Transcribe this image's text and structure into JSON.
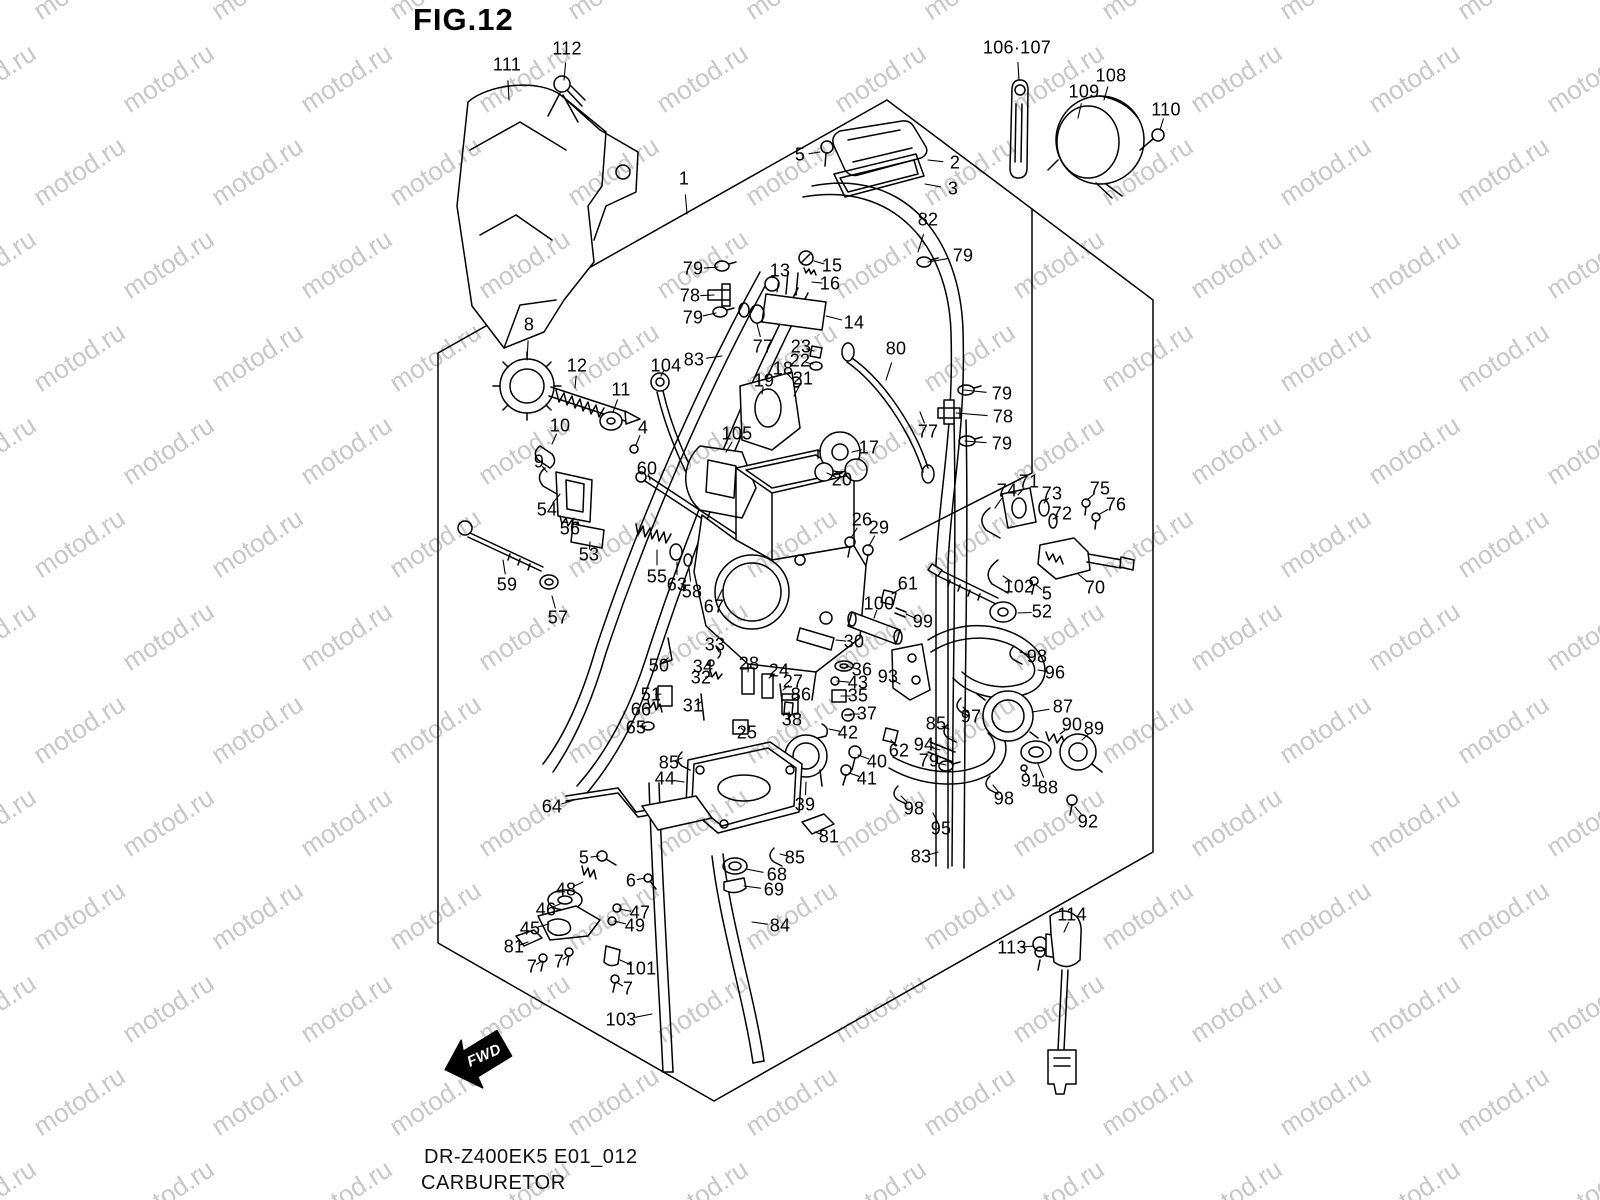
{
  "figure": {
    "label": "FIG.12"
  },
  "footer": {
    "model_code": "DR-Z400EK5 E01_012",
    "title": "CARBURETOR"
  },
  "fwd_label": "FWD",
  "watermark": {
    "text": "motod.ru"
  },
  "colors": {
    "line": "#000000",
    "watermark": "#c3c3c3",
    "background": "#ffffff"
  },
  "part_labels": [
    {
      "t": "112",
      "x": 567,
      "y": 49,
      "tx": 564,
      "ty": 80
    },
    {
      "t": "111",
      "x": 507,
      "y": 65,
      "tx": 509,
      "ty": 100
    },
    {
      "t": "106·107",
      "x": 1017,
      "y": 48,
      "tx": 1019,
      "ty": 80
    },
    {
      "t": "108",
      "x": 1111,
      "y": 76,
      "tx": 1104,
      "ty": 100
    },
    {
      "t": "109",
      "x": 1084,
      "y": 92,
      "tx": 1078,
      "ty": 118
    },
    {
      "t": "110",
      "x": 1166,
      "y": 110,
      "tx": 1160,
      "ty": 130
    },
    {
      "t": "5",
      "x": 800,
      "y": 155,
      "tx": 820,
      "ty": 152
    },
    {
      "t": "2",
      "x": 955,
      "y": 163,
      "tx": 928,
      "ty": 160
    },
    {
      "t": "3",
      "x": 953,
      "y": 189,
      "tx": 925,
      "ty": 184
    },
    {
      "t": "1",
      "x": 684,
      "y": 179,
      "tx": 687,
      "ty": 214
    },
    {
      "t": "82",
      "x": 928,
      "y": 220,
      "tx": 918,
      "ty": 252
    },
    {
      "t": "79",
      "x": 963,
      "y": 256,
      "tx": 928,
      "ty": 262
    },
    {
      "t": "79",
      "x": 693,
      "y": 269,
      "tx": 718,
      "ty": 267
    },
    {
      "t": "13",
      "x": 780,
      "y": 271,
      "tx": 777,
      "ty": 292
    },
    {
      "t": "15",
      "x": 832,
      "y": 266,
      "tx": 814,
      "ty": 261
    },
    {
      "t": "16",
      "x": 830,
      "y": 284,
      "tx": 812,
      "ty": 282
    },
    {
      "t": "78",
      "x": 690,
      "y": 296,
      "tx": 714,
      "ty": 295
    },
    {
      "t": "79",
      "x": 693,
      "y": 318,
      "tx": 716,
      "ty": 313
    },
    {
      "t": "14",
      "x": 854,
      "y": 323,
      "tx": 826,
      "ty": 316
    },
    {
      "t": "77",
      "x": 763,
      "y": 347,
      "tx": 757,
      "ty": 324
    },
    {
      "t": "23",
      "x": 801,
      "y": 347,
      "tx": 814,
      "ty": 351
    },
    {
      "t": "80",
      "x": 896,
      "y": 349,
      "tx": 886,
      "ty": 380
    },
    {
      "t": "22",
      "x": 800,
      "y": 361,
      "tx": 813,
      "ty": 364
    },
    {
      "t": "8",
      "x": 529,
      "y": 325,
      "tx": 527,
      "ty": 360
    },
    {
      "t": "12",
      "x": 577,
      "y": 366,
      "tx": 575,
      "ty": 388
    },
    {
      "t": "104",
      "x": 666,
      "y": 366,
      "tx": 661,
      "ty": 376
    },
    {
      "t": "83",
      "x": 694,
      "y": 360,
      "tx": 722,
      "ty": 356
    },
    {
      "t": "18",
      "x": 783,
      "y": 369,
      "tx": 793,
      "ty": 380
    },
    {
      "t": "21",
      "x": 803,
      "y": 379,
      "tx": 794,
      "ty": 396
    },
    {
      "t": "19",
      "x": 764,
      "y": 381,
      "tx": 762,
      "ty": 394
    },
    {
      "t": "11",
      "x": 621,
      "y": 390,
      "tx": 613,
      "ty": 412
    },
    {
      "t": "79",
      "x": 1002,
      "y": 394,
      "tx": 964,
      "ty": 390
    },
    {
      "t": "78",
      "x": 1003,
      "y": 417,
      "tx": 956,
      "ty": 413
    },
    {
      "t": "77",
      "x": 928,
      "y": 432,
      "tx": 920,
      "ty": 412
    },
    {
      "t": "79",
      "x": 1002,
      "y": 444,
      "tx": 965,
      "ty": 441
    },
    {
      "t": "10",
      "x": 560,
      "y": 426,
      "tx": 552,
      "ty": 444
    },
    {
      "t": "4",
      "x": 643,
      "y": 428,
      "tx": 636,
      "ty": 445
    },
    {
      "t": "105",
      "x": 737,
      "y": 434,
      "tx": 726,
      "ty": 452
    },
    {
      "t": "9",
      "x": 539,
      "y": 462,
      "tx": 547,
      "ty": 472
    },
    {
      "t": "17",
      "x": 869,
      "y": 448,
      "tx": 852,
      "ty": 452
    },
    {
      "t": "60",
      "x": 647,
      "y": 469,
      "tx": 650,
      "ty": 480
    },
    {
      "t": "20",
      "x": 842,
      "y": 480,
      "tx": 827,
      "ty": 473
    },
    {
      "t": "71",
      "x": 1029,
      "y": 482,
      "tx": 1018,
      "ty": 495
    },
    {
      "t": "74",
      "x": 1007,
      "y": 491,
      "tx": 995,
      "ty": 508
    },
    {
      "t": "73",
      "x": 1052,
      "y": 494,
      "tx": 1044,
      "ty": 503
    },
    {
      "t": "75",
      "x": 1100,
      "y": 489,
      "tx": 1087,
      "ty": 500
    },
    {
      "t": "76",
      "x": 1116,
      "y": 505,
      "tx": 1098,
      "ty": 515
    },
    {
      "t": "72",
      "x": 1062,
      "y": 514,
      "tx": 1053,
      "ty": 519
    },
    {
      "t": "54",
      "x": 547,
      "y": 510,
      "tx": 560,
      "ty": 494
    },
    {
      "t": "26",
      "x": 862,
      "y": 520,
      "tx": 851,
      "ty": 538
    },
    {
      "t": "29",
      "x": 879,
      "y": 528,
      "tx": 869,
      "ty": 546
    },
    {
      "t": "56",
      "x": 570,
      "y": 529,
      "tx": 574,
      "ty": 518
    },
    {
      "t": "53",
      "x": 589,
      "y": 555,
      "tx": 590,
      "ty": 542
    },
    {
      "t": "59",
      "x": 507,
      "y": 585,
      "tx": 503,
      "ty": 560
    },
    {
      "t": "55",
      "x": 657,
      "y": 577,
      "tx": 657,
      "ty": 550
    },
    {
      "t": "63",
      "x": 677,
      "y": 585,
      "tx": 677,
      "ty": 562
    },
    {
      "t": "58",
      "x": 692,
      "y": 592,
      "tx": 689,
      "ty": 568
    },
    {
      "t": "61",
      "x": 908,
      "y": 584,
      "tx": 892,
      "ty": 594
    },
    {
      "t": "102",
      "x": 1019,
      "y": 587,
      "tx": 1003,
      "ty": 576
    },
    {
      "t": "5",
      "x": 1047,
      "y": 594,
      "tx": 1035,
      "ty": 584
    },
    {
      "t": "70",
      "x": 1095,
      "y": 588,
      "tx": 1078,
      "ty": 574
    },
    {
      "t": "100",
      "x": 879,
      "y": 604,
      "tx": 874,
      "ty": 618
    },
    {
      "t": "52",
      "x": 1042,
      "y": 612,
      "tx": 1018,
      "ty": 613
    },
    {
      "t": "57",
      "x": 558,
      "y": 618,
      "tx": 552,
      "ty": 596
    },
    {
      "t": "99",
      "x": 923,
      "y": 622,
      "tx": 906,
      "ty": 614
    },
    {
      "t": "67",
      "x": 714,
      "y": 607,
      "tx": 722,
      "ty": 590
    },
    {
      "t": "33",
      "x": 715,
      "y": 645,
      "tx": 719,
      "ty": 652
    },
    {
      "t": "30",
      "x": 854,
      "y": 642,
      "tx": 836,
      "ty": 640
    },
    {
      "t": "34",
      "x": 703,
      "y": 667,
      "tx": 710,
      "ty": 664
    },
    {
      "t": "50",
      "x": 659,
      "y": 666,
      "tx": 668,
      "ty": 658
    },
    {
      "t": "28",
      "x": 749,
      "y": 664,
      "tx": 748,
      "ty": 672
    },
    {
      "t": "24",
      "x": 779,
      "y": 671,
      "tx": 769,
      "ty": 678
    },
    {
      "t": "98",
      "x": 1037,
      "y": 657,
      "tx": 1020,
      "ty": 652
    },
    {
      "t": "36",
      "x": 862,
      "y": 670,
      "tx": 846,
      "ty": 666
    },
    {
      "t": "96",
      "x": 1055,
      "y": 673,
      "tx": 1038,
      "ty": 670
    },
    {
      "t": "32",
      "x": 701,
      "y": 678,
      "tx": 711,
      "ty": 676
    },
    {
      "t": "27",
      "x": 793,
      "y": 682,
      "tx": 783,
      "ty": 690
    },
    {
      "t": "43",
      "x": 858,
      "y": 683,
      "tx": 837,
      "ty": 681
    },
    {
      "t": "86",
      "x": 801,
      "y": 695,
      "tx": 792,
      "ty": 700
    },
    {
      "t": "51",
      "x": 651,
      "y": 695,
      "tx": 661,
      "ty": 694
    },
    {
      "t": "35",
      "x": 858,
      "y": 696,
      "tx": 841,
      "ty": 696
    },
    {
      "t": "31",
      "x": 693,
      "y": 706,
      "tx": 701,
      "ty": 702
    },
    {
      "t": "66",
      "x": 641,
      "y": 710,
      "tx": 651,
      "ty": 707
    },
    {
      "t": "37",
      "x": 867,
      "y": 714,
      "tx": 850,
      "ty": 714
    },
    {
      "t": "87",
      "x": 1063,
      "y": 707,
      "tx": 1032,
      "ty": 712
    },
    {
      "t": "65",
      "x": 636,
      "y": 728,
      "tx": 646,
      "ty": 726
    },
    {
      "t": "25",
      "x": 747,
      "y": 733,
      "tx": 741,
      "ty": 728
    },
    {
      "t": "38",
      "x": 792,
      "y": 720,
      "tx": 789,
      "ty": 712
    },
    {
      "t": "97",
      "x": 971,
      "y": 717,
      "tx": 963,
      "ty": 707
    },
    {
      "t": "85",
      "x": 936,
      "y": 724,
      "tx": 949,
      "ty": 729
    },
    {
      "t": "90",
      "x": 1072,
      "y": 725,
      "tx": 1060,
      "ty": 734
    },
    {
      "t": "89",
      "x": 1094,
      "y": 729,
      "tx": 1082,
      "ty": 740
    },
    {
      "t": "62",
      "x": 899,
      "y": 751,
      "tx": 891,
      "ty": 740
    },
    {
      "t": "94",
      "x": 924,
      "y": 745,
      "tx": 940,
      "ty": 750
    },
    {
      "t": "42",
      "x": 848,
      "y": 733,
      "tx": 829,
      "ty": 729
    },
    {
      "t": "79",
      "x": 929,
      "y": 761,
      "tx": 946,
      "ty": 765
    },
    {
      "t": "40",
      "x": 877,
      "y": 762,
      "tx": 858,
      "ty": 755
    },
    {
      "t": "85",
      "x": 669,
      "y": 763,
      "tx": 682,
      "ty": 758
    },
    {
      "t": "44",
      "x": 665,
      "y": 779,
      "tx": 684,
      "ty": 782
    },
    {
      "t": "91",
      "x": 1031,
      "y": 781,
      "tx": 1024,
      "ty": 770
    },
    {
      "t": "88",
      "x": 1048,
      "y": 788,
      "tx": 1038,
      "ty": 764
    },
    {
      "t": "41",
      "x": 867,
      "y": 779,
      "tx": 849,
      "ty": 773
    },
    {
      "t": "39",
      "x": 805,
      "y": 805,
      "tx": 806,
      "ty": 782
    },
    {
      "t": "98",
      "x": 1004,
      "y": 799,
      "tx": 993,
      "ty": 785
    },
    {
      "t": "92",
      "x": 1088,
      "y": 822,
      "tx": 1075,
      "ty": 807
    },
    {
      "t": "98",
      "x": 914,
      "y": 809,
      "tx": 901,
      "ty": 796
    },
    {
      "t": "64",
      "x": 552,
      "y": 807,
      "tx": 574,
      "ty": 800
    },
    {
      "t": "95",
      "x": 941,
      "y": 829,
      "tx": 933,
      "ty": 813
    },
    {
      "t": "81",
      "x": 829,
      "y": 837,
      "tx": 815,
      "ty": 832
    },
    {
      "t": "85",
      "x": 795,
      "y": 858,
      "tx": 780,
      "ty": 854
    },
    {
      "t": "83",
      "x": 921,
      "y": 857,
      "tx": 938,
      "ty": 852
    },
    {
      "t": "5",
      "x": 584,
      "y": 858,
      "tx": 599,
      "ty": 856
    },
    {
      "t": "6",
      "x": 631,
      "y": 881,
      "tx": 645,
      "ty": 878
    },
    {
      "t": "68",
      "x": 777,
      "y": 875,
      "tx": 746,
      "ty": 869
    },
    {
      "t": "48",
      "x": 566,
      "y": 890,
      "tx": 583,
      "ty": 882
    },
    {
      "t": "69",
      "x": 774,
      "y": 890,
      "tx": 744,
      "ty": 886
    },
    {
      "t": "46",
      "x": 546,
      "y": 910,
      "tx": 562,
      "ty": 903
    },
    {
      "t": "47",
      "x": 640,
      "y": 913,
      "tx": 619,
      "ty": 909
    },
    {
      "t": "49",
      "x": 635,
      "y": 926,
      "tx": 614,
      "ty": 921
    },
    {
      "t": "45",
      "x": 530,
      "y": 929,
      "tx": 549,
      "ty": 924
    },
    {
      "t": "84",
      "x": 780,
      "y": 926,
      "tx": 752,
      "ty": 922
    },
    {
      "t": "114",
      "x": 1072,
      "y": 915,
      "tx": 1064,
      "ty": 932
    },
    {
      "t": "81",
      "x": 514,
      "y": 947,
      "tx": 528,
      "ty": 942
    },
    {
      "t": "113",
      "x": 1012,
      "y": 948,
      "tx": 1034,
      "ty": 946
    },
    {
      "t": "7",
      "x": 532,
      "y": 967,
      "tx": 542,
      "ty": 961
    },
    {
      "t": "7",
      "x": 559,
      "y": 962,
      "tx": 568,
      "ty": 956
    },
    {
      "t": "101",
      "x": 641,
      "y": 969,
      "tx": 620,
      "ty": 960
    },
    {
      "t": "7",
      "x": 628,
      "y": 989,
      "tx": 616,
      "ty": 982
    },
    {
      "t": "103",
      "x": 621,
      "y": 1020,
      "tx": 652,
      "ty": 1014
    },
    {
      "t": "93",
      "x": 888,
      "y": 677,
      "tx": 900,
      "ty": 684
    }
  ]
}
